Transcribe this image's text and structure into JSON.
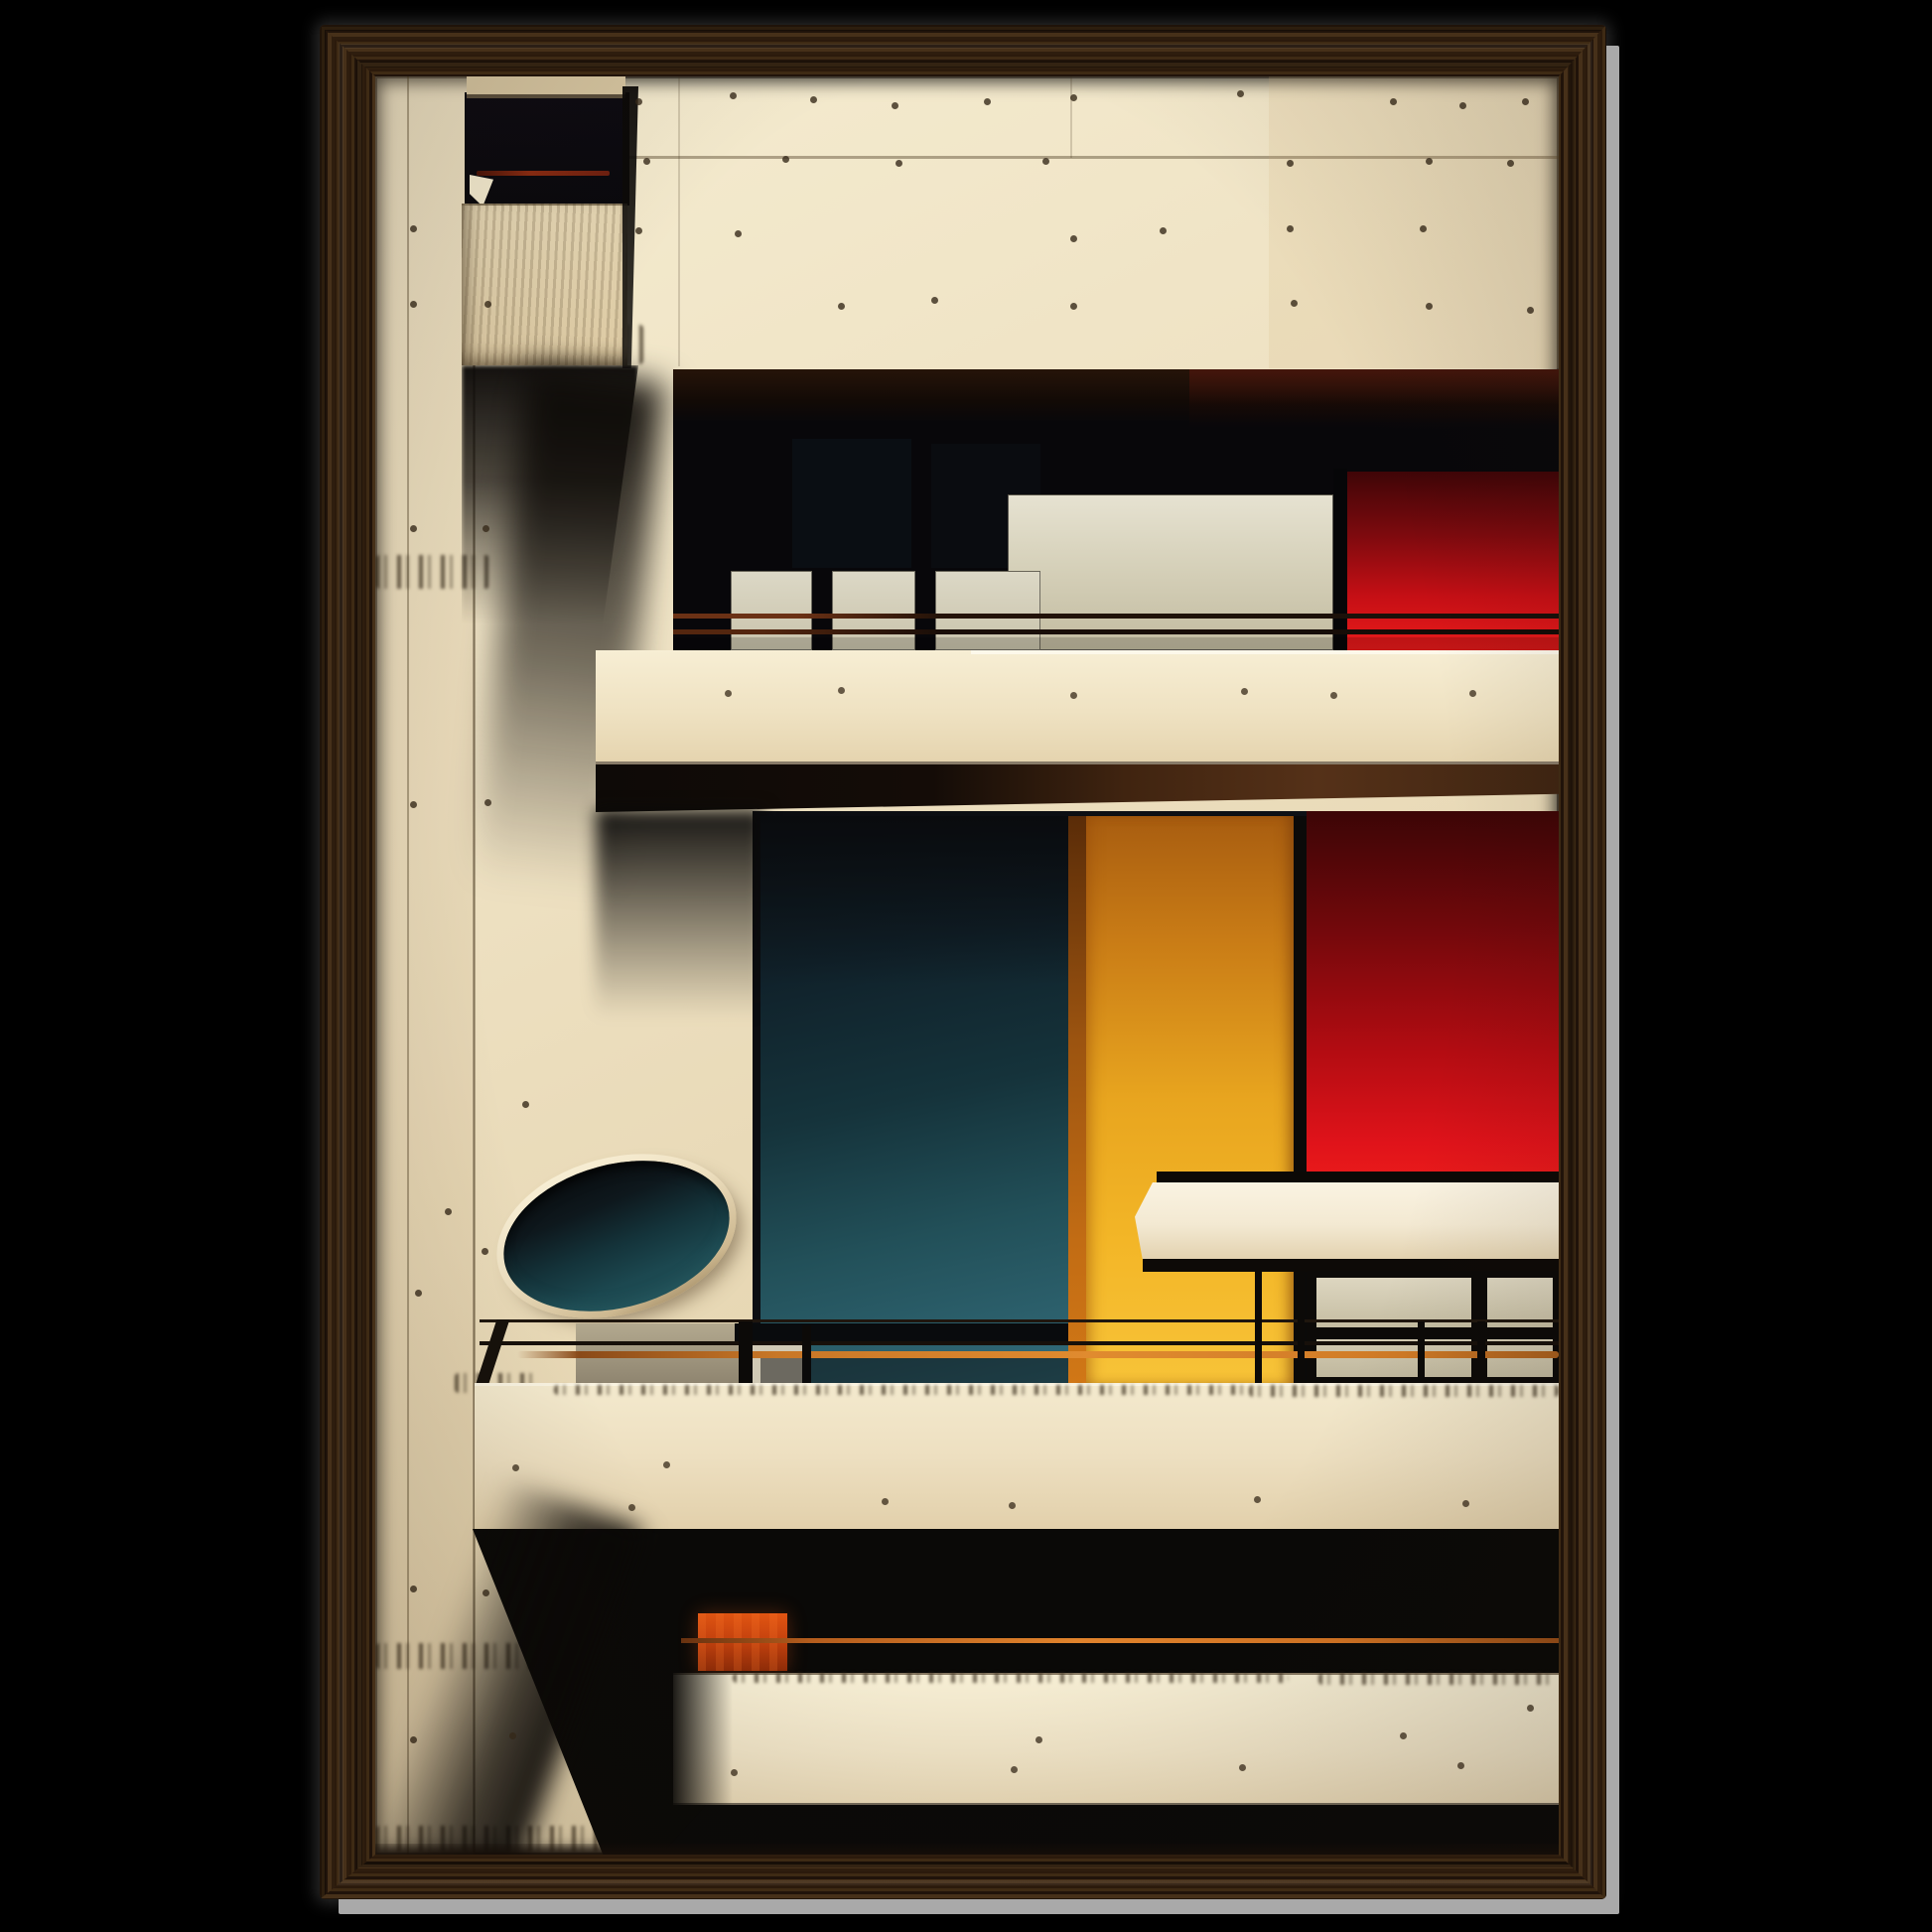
{
  "page": {
    "background": "#000000"
  },
  "product": {
    "name": "framed-art-print",
    "frame": {
      "material": "dark-walnut-wood-grain",
      "profile": "flat-rail-mitered-corners"
    }
  },
  "artwork": {
    "subject": "bauhaus-modernist-building-facade",
    "orientation": "portrait",
    "regions": [
      {
        "name": "concrete-facade",
        "color": "#eee1c2"
      },
      {
        "name": "upper-left-balcony-block",
        "color": "#e2d2ad"
      },
      {
        "name": "upper-balcony-recess",
        "color": "#08070a"
      },
      {
        "name": "window-panels",
        "color": "#d6d1ba"
      },
      {
        "name": "upper-red-panel",
        "color": "#c60f15"
      },
      {
        "name": "parapet-band",
        "color": "#efe2c2"
      },
      {
        "name": "soffit-underside",
        "color": "#553118"
      },
      {
        "name": "teal-panel",
        "color": "#225059"
      },
      {
        "name": "yellow-column",
        "color": "#e8a51f"
      },
      {
        "name": "middle-red-panel",
        "color": "#e0131a"
      },
      {
        "name": "white-ledge",
        "color": "#faf3e2"
      },
      {
        "name": "porthole-ellipse",
        "color": "#14333a"
      },
      {
        "name": "balcony-railing",
        "color": "#17100a"
      },
      {
        "name": "orange-handrail",
        "color": "#e08b2f"
      },
      {
        "name": "orange-box",
        "color": "#c8430e"
      },
      {
        "name": "lower-parapet",
        "color": "#eddfc0"
      },
      {
        "name": "bottom-floor-band",
        "color": "#efe3c6"
      }
    ]
  },
  "colors": {
    "page-bg": "#000000",
    "side-gray": "#a9a9a9",
    "wood-a": "#2b1a0c",
    "wood-b": "#3e2a14",
    "wood-c": "#20130a",
    "wood-d": "#463019",
    "wood-e": "#2e1d0e",
    "concrete-hi": "#f5ecd0",
    "concrete": "#eee1c2",
    "concrete-mid": "#e6d6b2",
    "concrete-lo": "#dcc9a2",
    "recess-black": "#08070a",
    "panel-gray-hi": "#e6e2d1",
    "panel-gray": "#d6d1ba",
    "panel-gray-lo": "#c2bba0",
    "red-hi": "#ea1b1b",
    "red": "#c60f15",
    "red-mid": "#7c0a0e",
    "red-lo": "#3f0507",
    "teal-hi": "#33707e",
    "teal": "#225059",
    "teal-mid": "#15333b",
    "teal-lo": "#0e181d",
    "yellow-hi": "#f7c338",
    "yellow": "#e8a51f",
    "yellow-mid": "#c97c16",
    "yellow-lo": "#a85d10",
    "orange-edge": "#d07716",
    "orange-rail": "#e08b2f",
    "orange-box": "#c8430e",
    "rust": "#8c2c12",
    "soffit-brown": "#553118",
    "ledge-white": "#faf3e2",
    "line-black": "#17100a",
    "stain": "#3b2c18",
    "navy": "#10151c"
  }
}
